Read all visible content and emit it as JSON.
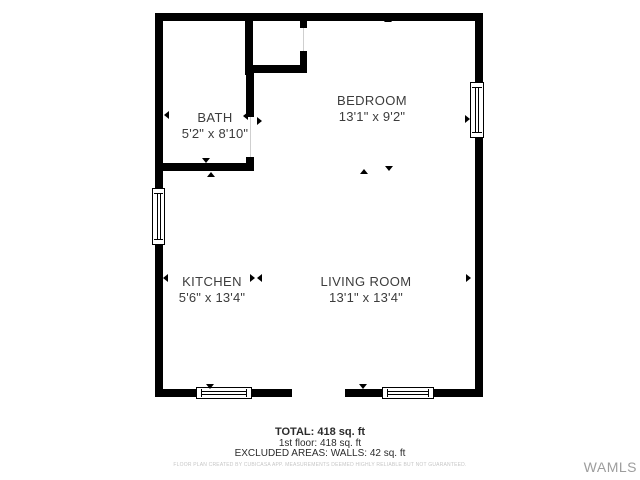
{
  "floor_plan": {
    "rooms": [
      {
        "name": "BATH",
        "dims": "5'2\" x 8'10\""
      },
      {
        "name": "BEDROOM",
        "dims": "13'1\" x 9'2\""
      },
      {
        "name": "KITCHEN",
        "dims": "5'6\" x 13'4\""
      },
      {
        "name": "LIVING ROOM",
        "dims": "13'1\" x 13'4\""
      }
    ],
    "colors": {
      "wall": "#000000",
      "label": "#3c3c3c",
      "opening_line": "#cfcfcf"
    }
  },
  "summary": {
    "total": "TOTAL: 418 sq. ft",
    "floor": "1st floor: 418 sq. ft",
    "excluded": "EXCLUDED AREAS: WALLS: 42 sq. ft",
    "disclaimer": "FLOOR PLAN CREATED BY CUBICASA APP. MEASUREMENTS DEEMED HIGHLY RELIABLE BUT NOT GUARANTEED."
  },
  "watermark": {
    "label": "WAMLS"
  }
}
